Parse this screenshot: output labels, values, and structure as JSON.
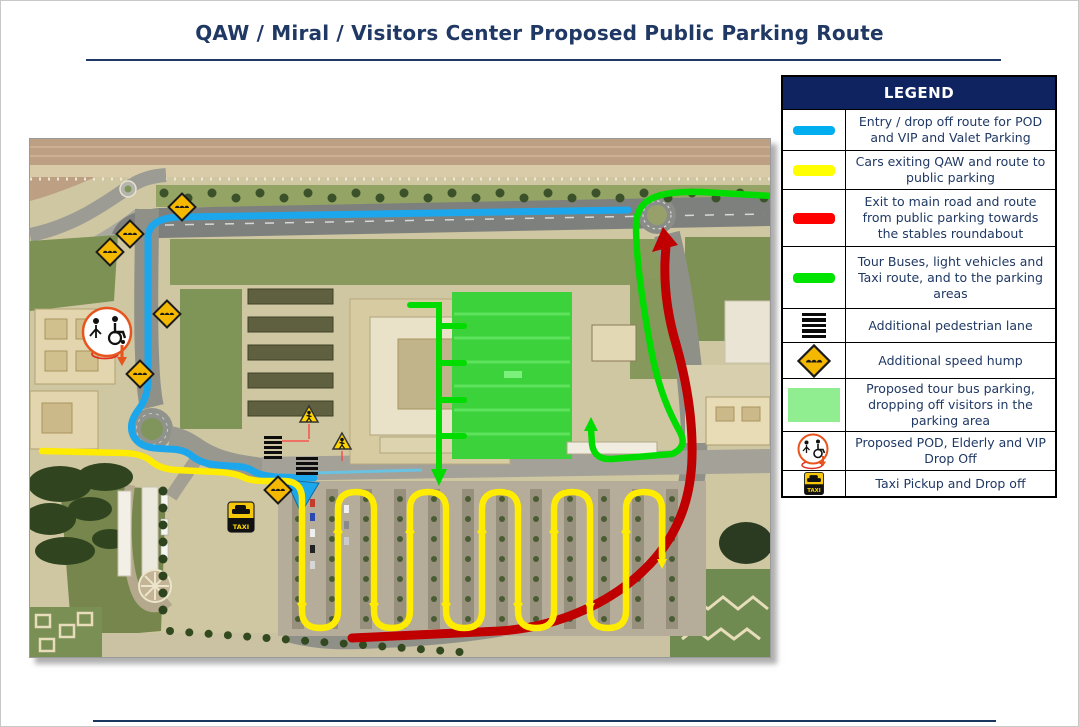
{
  "page": {
    "title": "QAW /  Miral / Visitors Center Proposed Public Parking Route"
  },
  "labels": {
    "taxi": "TAXI"
  },
  "legend": {
    "header": "LEGEND",
    "rows": [
      {
        "icon": "blue-route-swatch",
        "color": "#00adee",
        "text": "Entry / drop off route for POD and VIP and Valet Parking"
      },
      {
        "icon": "yellow-route-swatch",
        "color": "#ffff00",
        "text": "Cars exiting QAW and route to public parking"
      },
      {
        "icon": "red-route-swatch",
        "color": "#ff0000",
        "text": "Exit to main road and route from public parking towards the stables roundabout"
      },
      {
        "icon": "green-route-swatch",
        "color": "#00e400",
        "text": "Tour Buses, light vehicles and Taxi route, and to the parking areas"
      },
      {
        "icon": "pedestrian-lane-icon",
        "text": "Additional pedestrian lane"
      },
      {
        "icon": "speed-hump-icon",
        "text": "Additional speed hump"
      },
      {
        "icon": "tour-bus-parking-swatch",
        "color": "#90ee90",
        "text": "Proposed tour bus parking, dropping off visitors in the parking area"
      },
      {
        "icon": "pod-drop-off-icon",
        "text": "Proposed POD, Elderly and  VIP Drop Off"
      },
      {
        "icon": "taxi-pickup-icon",
        "text": "Taxi Pickup and Drop off"
      }
    ]
  },
  "map": {
    "route_colors": {
      "entry_blue": "#1ca7ec",
      "public_parking_yellow": "#ffec00",
      "exit_red": "#c00000",
      "tour_bus_green": "#00dc00",
      "bus_parking_area_fill": "#3bd23b"
    }
  }
}
